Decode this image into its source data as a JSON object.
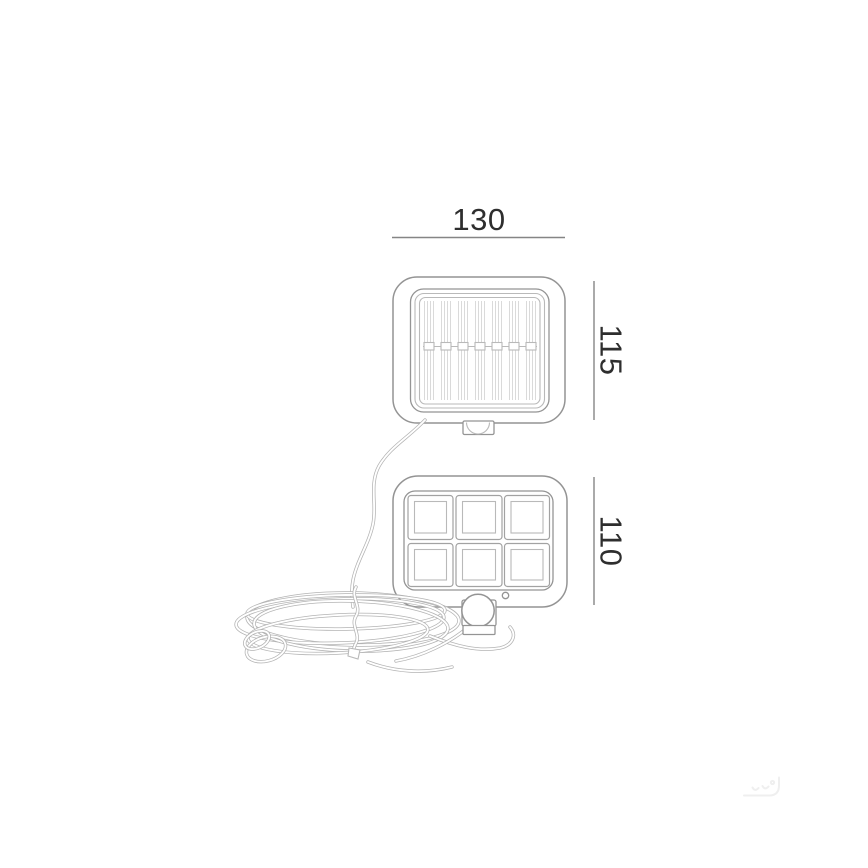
{
  "drawing": {
    "title": "solar-security-light-technical-drawing",
    "dimension_labels": {
      "width": "130",
      "solar_panel_height": "115",
      "lamp_height": "110"
    },
    "colors": {
      "background": "#ffffff",
      "outline": "#949494",
      "secondary_line": "#b9b9b9",
      "hatch_line": "#dadada",
      "cable_line": "#b3b3b3",
      "dimension_line": "#858585",
      "dimension_text": "#2e2e2e",
      "watermark": "#efefef"
    },
    "parts": {
      "solar_panel": {
        "hatch_columns": 7
      },
      "led_lamp": {
        "cell_rows": 2,
        "cell_columns": 3
      },
      "motion_sensor": {
        "indicator_dots": 1
      },
      "cable": {
        "style": "coiled-with-tie"
      }
    }
  }
}
